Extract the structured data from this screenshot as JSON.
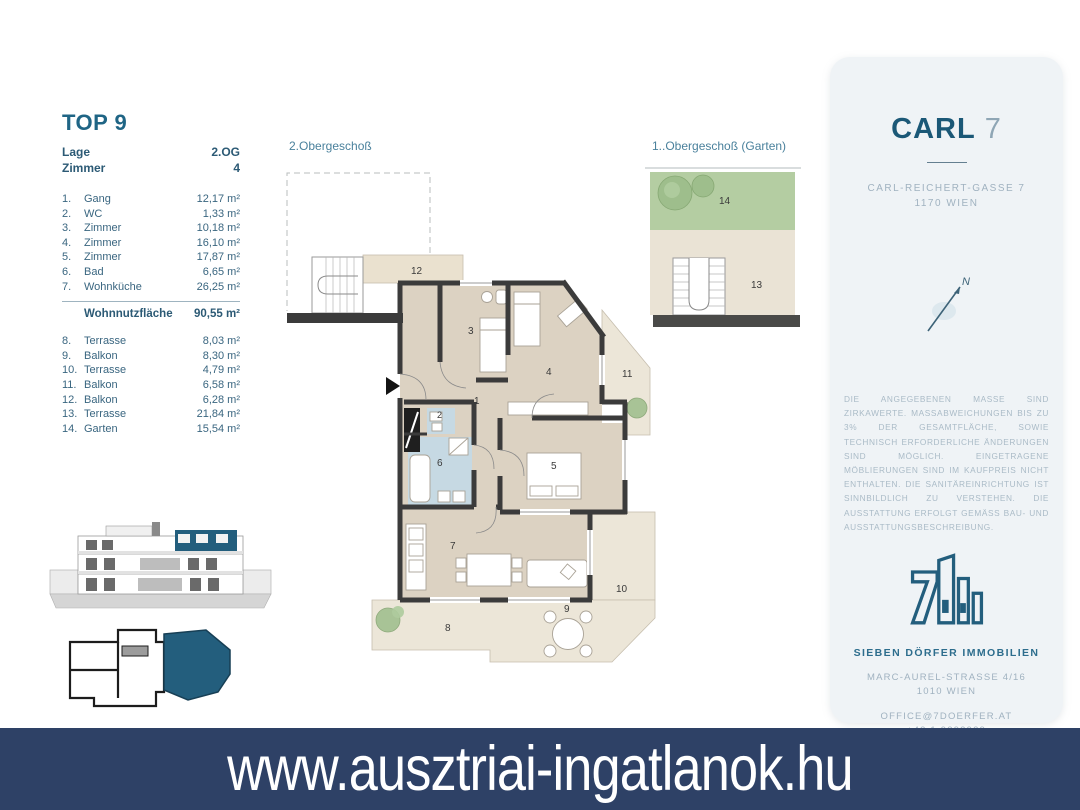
{
  "unit": {
    "title": "TOP 9",
    "lage_label": "Lage",
    "lage_value": "2.OG",
    "zimmer_label": "Zimmer",
    "zimmer_value": "4",
    "rooms": [
      {
        "num": "1.",
        "name": "Gang",
        "area": "12,17 m²"
      },
      {
        "num": "2.",
        "name": "WC",
        "area": "1,33 m²"
      },
      {
        "num": "3.",
        "name": "Zimmer",
        "area": "10,18 m²"
      },
      {
        "num": "4.",
        "name": "Zimmer",
        "area": "16,10 m²"
      },
      {
        "num": "5.",
        "name": "Zimmer",
        "area": "17,87 m²"
      },
      {
        "num": "6.",
        "name": "Bad",
        "area": "6,65 m²"
      },
      {
        "num": "7.",
        "name": "Wohnküche",
        "area": "26,25 m²"
      }
    ],
    "total_label": "Wohnnutzfläche",
    "total_value": "90,55 m²",
    "outdoor": [
      {
        "num": "8.",
        "name": "Terrasse",
        "area": "8,03 m²"
      },
      {
        "num": "9.",
        "name": "Balkon",
        "area": "8,30 m²"
      },
      {
        "num": "10.",
        "name": "Terrasse",
        "area": "4,79 m²"
      },
      {
        "num": "11.",
        "name": "Balkon",
        "area": "6,58 m²"
      },
      {
        "num": "12.",
        "name": "Balkon",
        "area": "6,28 m²"
      },
      {
        "num": "13.",
        "name": "Terrasse",
        "area": "21,84 m²"
      },
      {
        "num": "14.",
        "name": "Garten",
        "area": "15,54 m²"
      }
    ]
  },
  "plans": {
    "main_label": "2.Obergeschoß",
    "garden_label": "1..Obergeschoß (Garten)",
    "labels": {
      "n1": "1",
      "n2": "2",
      "n3": "3",
      "n4": "4",
      "n5": "5",
      "n6": "6",
      "n7": "7",
      "n8": "8",
      "n9": "9",
      "n10": "10",
      "n11": "11",
      "n12": "12",
      "n13": "13",
      "n14": "14"
    }
  },
  "panel": {
    "project_name": "CARL",
    "project_number": "7",
    "address_line1": "CARL-REICHERT-GASSE 7",
    "address_line2": "1170 WIEN",
    "compass_letter": "N",
    "disclaimer": "DIE ANGEGEBENEN MASSE SIND ZIRKAWERTE. MASSABWEICHUNGEN BIS ZU 3% DER GESAMTFLÄCHE, SOWIE TECHNISCH ERFORDERLICHE ÄNDERUNGEN SIND MÖGLICH. EINGETRAGENE MÖBLIERUNGEN SIND IM KAUFPREIS NICHT ENTHALTEN. DIE SANITÄREINRICHTUNG IST SINNBILDLICH ZU VERSTEHEN. DIE AUSSTATTUNG ERFOLGT GEMÄSS BAU- UND AUSSTATTUNGSBESCHREIBUNG.",
    "company": "SIEBEN DÖRFER IMMOBILIEN",
    "company_address1": "MARC-AUREL-STRASSE 4/16",
    "company_address2": "1010 WIEN",
    "email": "OFFICE@7DOERFER.AT",
    "phone": "+43 1 9392929"
  },
  "footer": {
    "url": "www.ausztriai-ingatlanok.hu"
  },
  "colors": {
    "accent_teal": "#1f6585",
    "banner_navy": "#2e4166",
    "wall": "#3b3b3b",
    "room_fill": "#dcd2c2",
    "terrace_fill": "#ece6d8",
    "wet_fill": "#c6d9e3",
    "garden_green": "#b4cda2",
    "unit_highlight": "#235e7d"
  }
}
